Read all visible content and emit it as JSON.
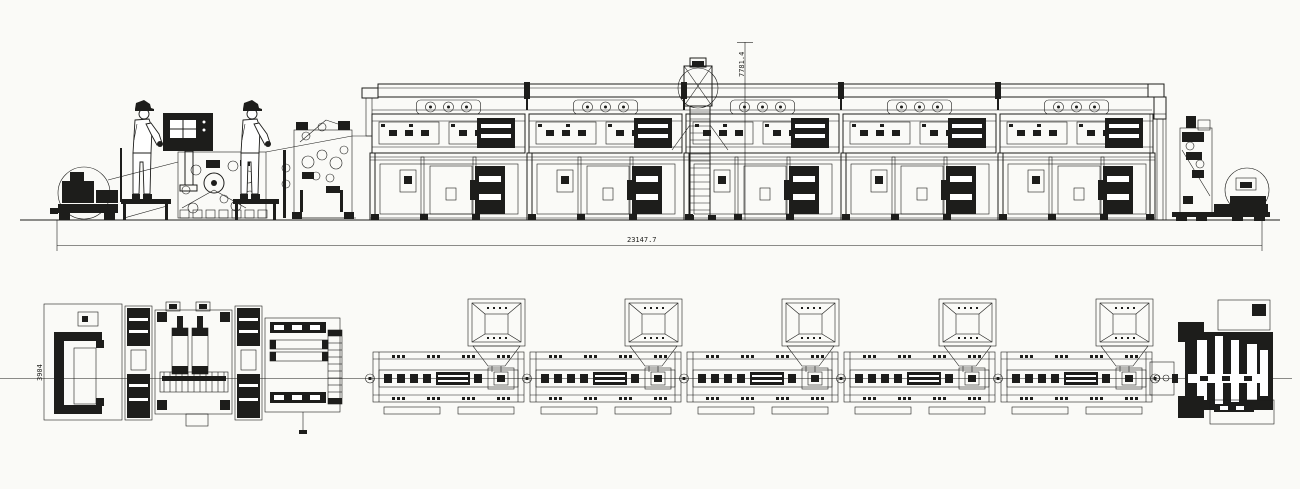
{
  "colors": {
    "background": "#fafaf7",
    "line": "#1d1d1b"
  },
  "dimensions": {
    "total_length_label": "23147.7",
    "height_label": "7781.4",
    "width_label": "3904"
  },
  "equipment": {
    "oven_module_count": 5,
    "vent_circles_per_module": 3,
    "hoppers_per_module": 1,
    "operator_count": 2,
    "walkway_platform_count": 2
  },
  "icons": {
    "operator": "worker-with-hard-hat",
    "vent": "circle-port",
    "ladder": "rung-ladder",
    "roll": "web-roll-circle"
  }
}
